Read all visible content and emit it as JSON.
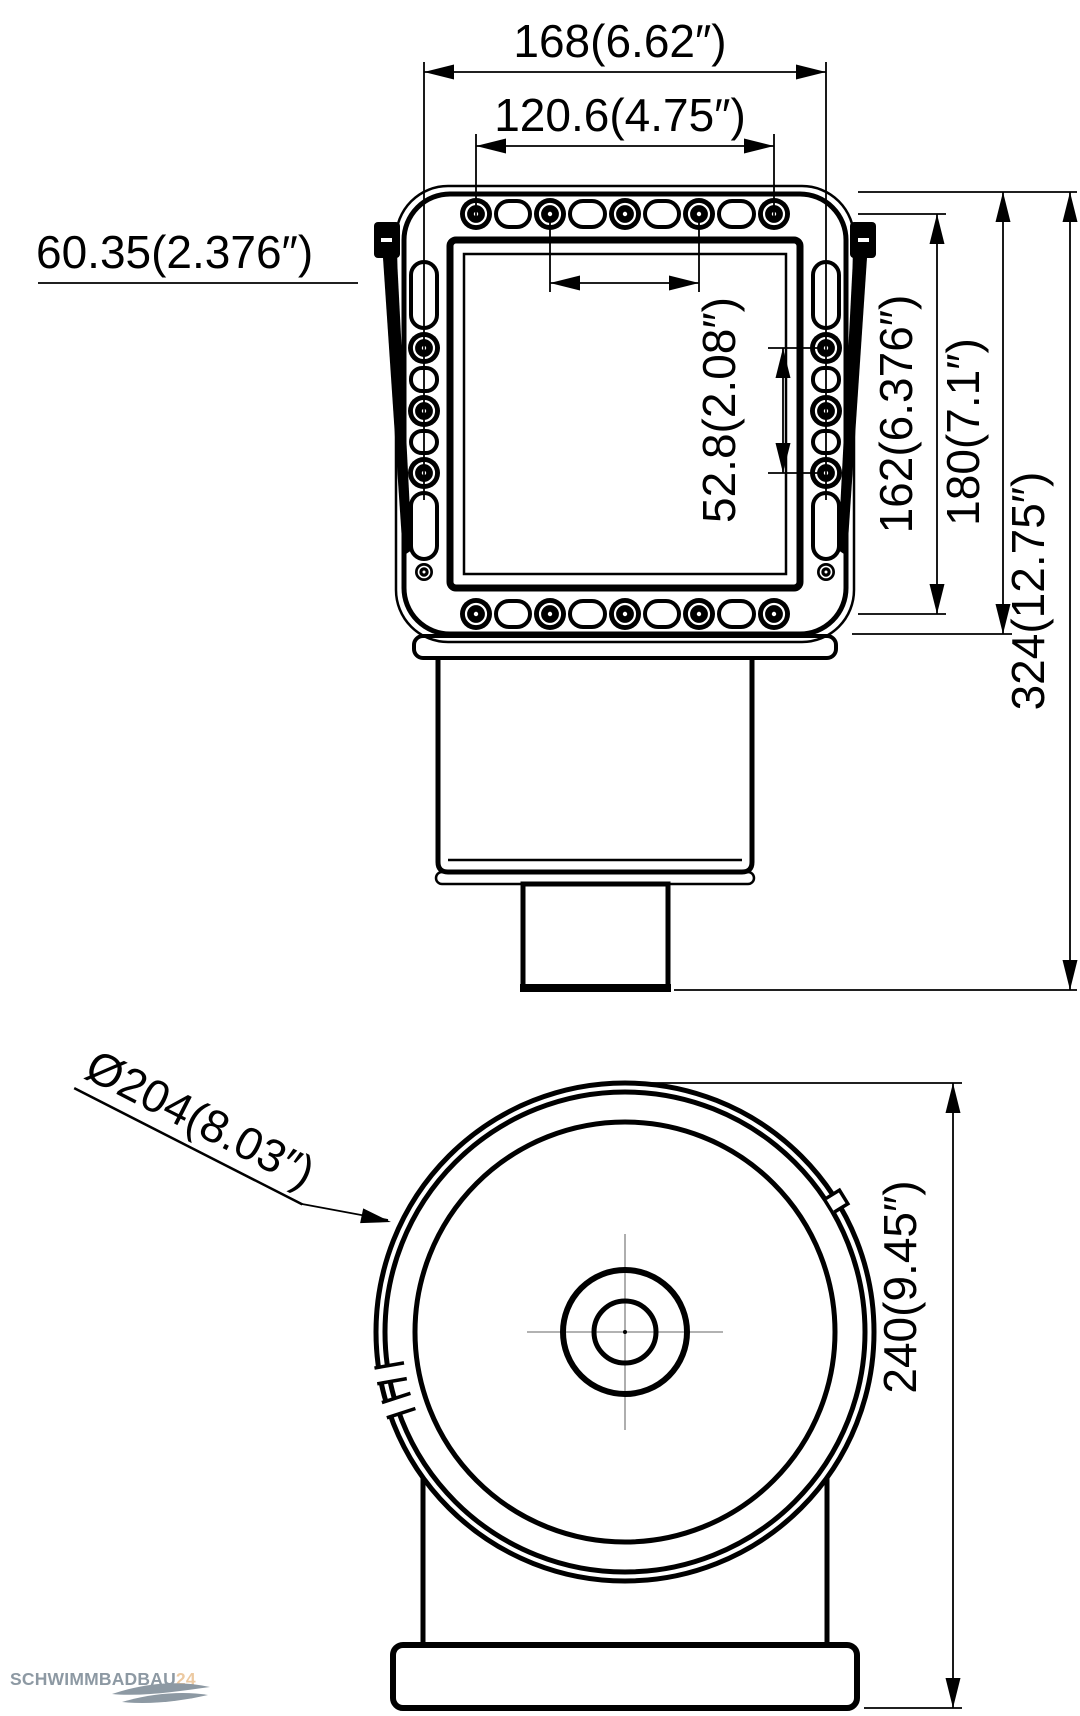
{
  "colors": {
    "ink": "#000000",
    "background": "#ffffff",
    "centerline": "#999999",
    "watermark_gray": "#8d99a3",
    "watermark_orange": "#ecc9a1"
  },
  "front_view": {
    "dimensions": {
      "mount_width": "168(6.62″)",
      "top_hole_span": "120.6(4.75″)",
      "top_hole_pitch": "60.35(2.376″)",
      "side_hole_pitch": "52.8(2.08″)",
      "mount_height": "162(6.376″)",
      "faceplate_height": "180(7.1″)",
      "overall_height": "324(12.75″)"
    }
  },
  "lid_view": {
    "dimensions": {
      "lid_diameter": "Ø204(8.03″)",
      "overall_height": "240(9.45″)"
    }
  },
  "watermark": {
    "brand": "SCHWIMMBADBAU",
    "suffix": "24"
  }
}
